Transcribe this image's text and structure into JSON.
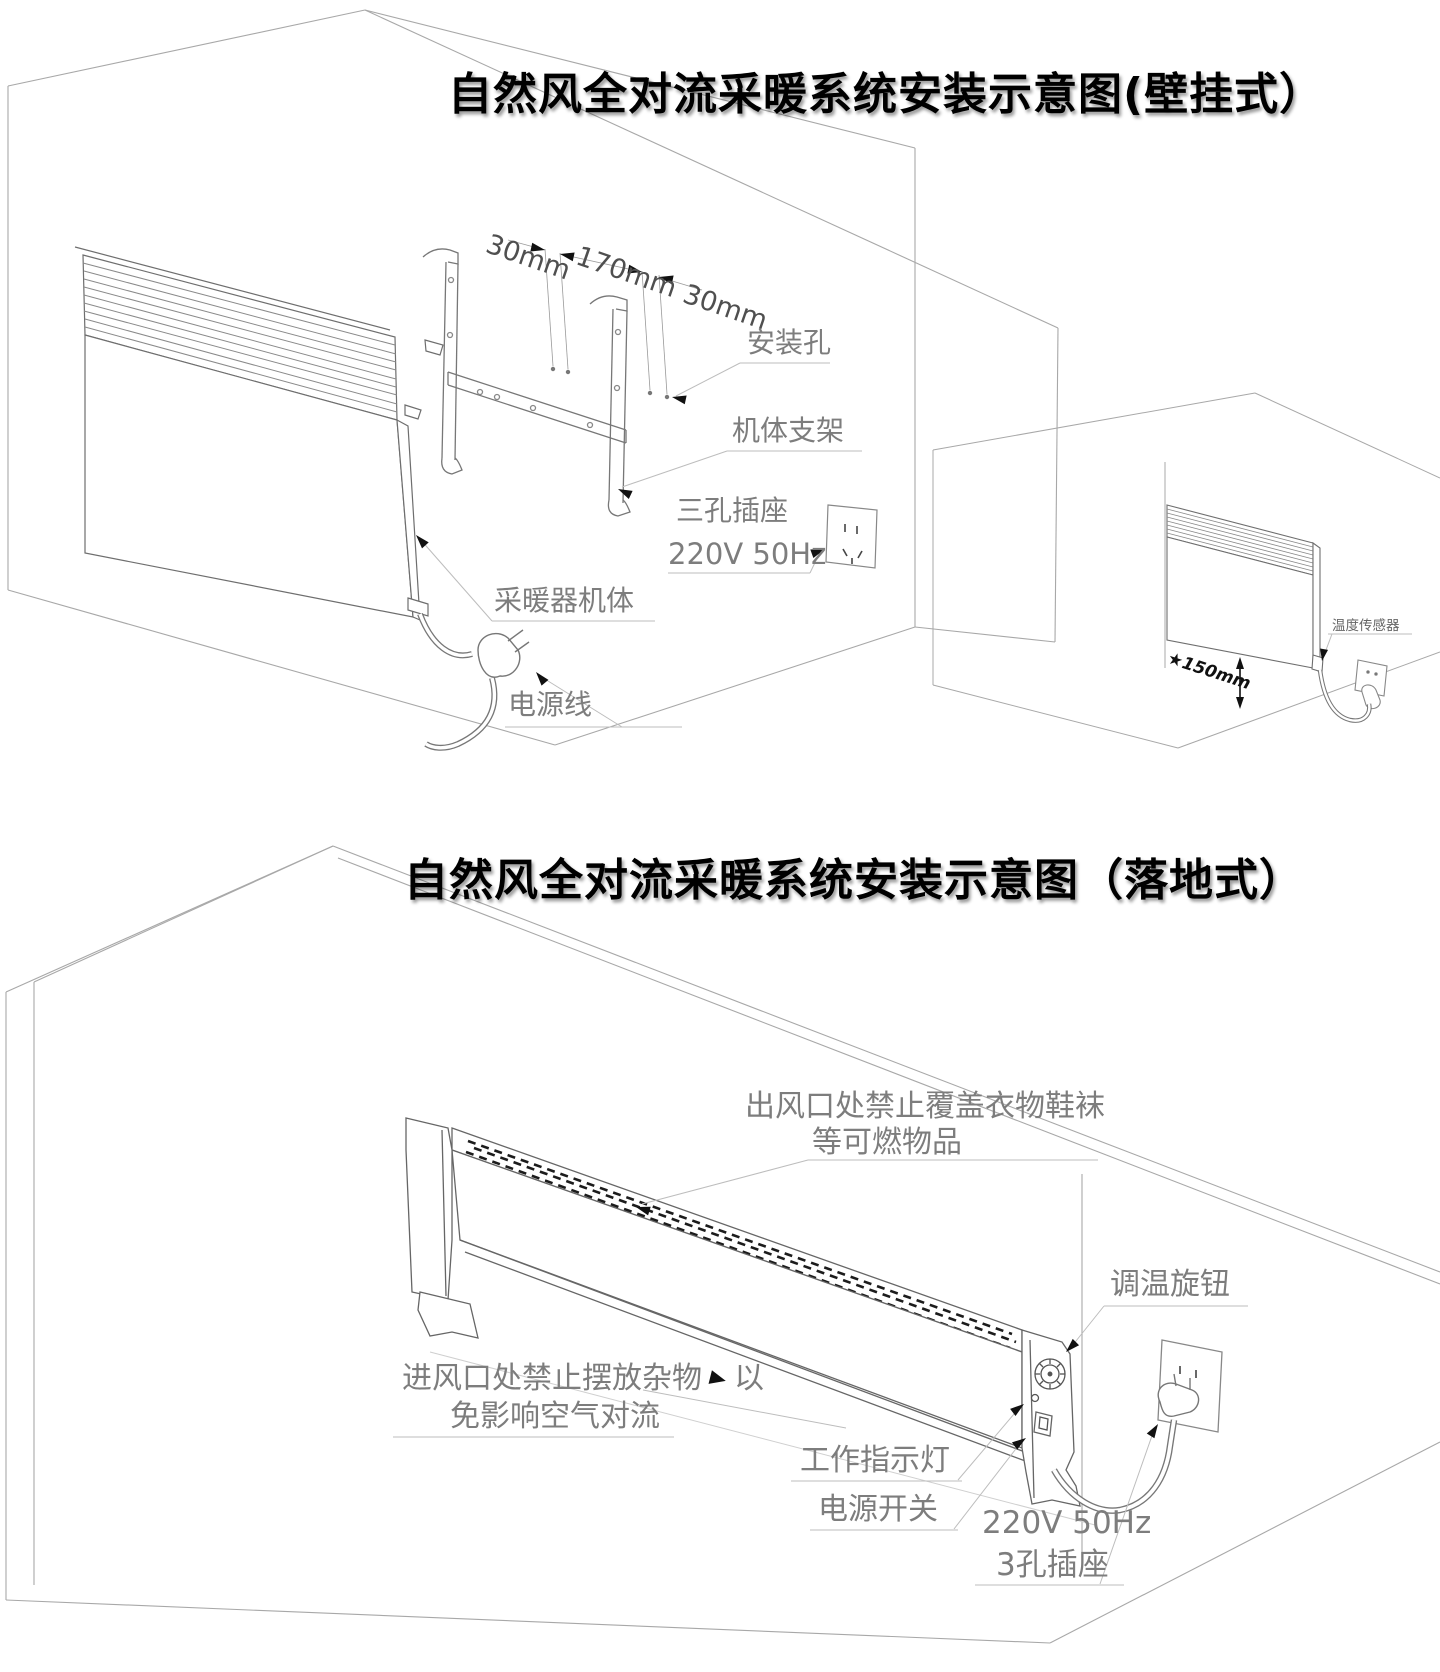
{
  "titles": {
    "wall": "自然风全对流采暖系统安装示意图(壁挂式）",
    "floor": "自然风全对流采暖系统安装示意图（落地式）"
  },
  "wall": {
    "dim_left": "30mm",
    "dim_mid": "170mm",
    "dim_right": "30mm",
    "mounting_hole": "安装孔",
    "bracket": "机体支架",
    "socket_type": "三孔插座",
    "socket_power": "220V 50Hz",
    "heater_body": "采暖器机体",
    "power_cord": "电源线",
    "sensor": "温度传感器",
    "min_height": "★150mm"
  },
  "floor": {
    "outlet_warning_1": "出风口处禁止覆盖衣物鞋袜",
    "outlet_warning_2": "等可燃物品",
    "knob": "调温旋钮",
    "inlet_warning_prefix": "进风口处禁止摆放杂物",
    "inlet_warning_suffix": "以",
    "inlet_warning_2": "免影响空气对流",
    "indicator": "工作指示灯",
    "switch": "电源开关",
    "socket_power": "220V 50Hz",
    "socket_type": "3孔插座"
  },
  "colors": {
    "ink": "#000000",
    "label_gray": "#7d7d7d",
    "room_line": "#a8a8a8",
    "object_line": "#777777",
    "arrow_black": "#111111"
  }
}
